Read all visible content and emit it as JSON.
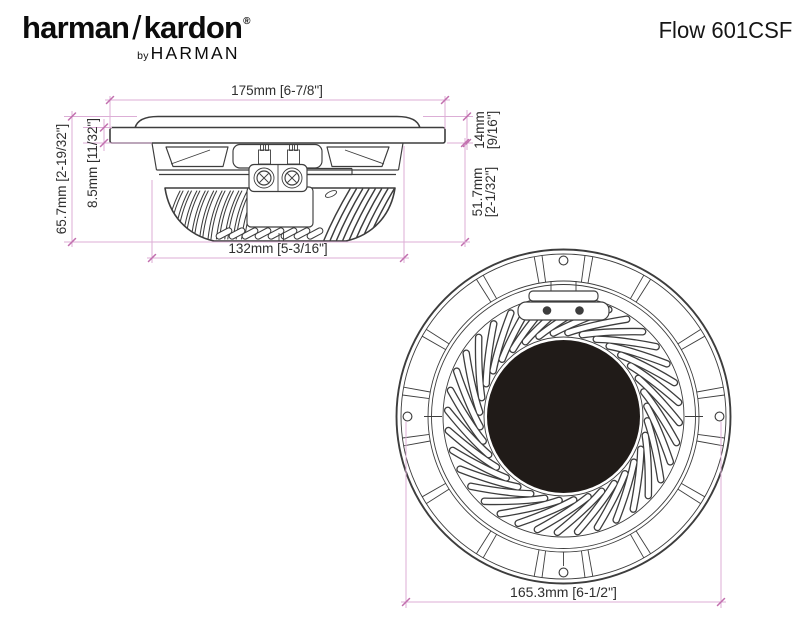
{
  "header": {
    "logo": {
      "part1": "harman",
      "slash": "/",
      "part2": "kardon",
      "reg": "®",
      "by": "by",
      "brand": "HARMAN"
    },
    "model": "Flow 601CSF"
  },
  "colors": {
    "line": "#3d3d3d",
    "dim": "#dcaed6",
    "tick": "#c26fae",
    "text": "#2e2e2e",
    "magnet": "#201b18",
    "bg": "#ffffff"
  },
  "side_view": {
    "dims": {
      "width_top": "175mm [6-7/8\"]",
      "flange_height_l1": "14mm",
      "flange_height_l2": "[9/16\"]",
      "depth_below_l1": "51.7mm",
      "depth_below_l2": "[2-1/32\"]",
      "total_height": "65.7mm [2-19/32\"]",
      "flange_thickness": "8.5mm [11/32\"]",
      "width_bottom": "132mm [5-3/16\"]"
    }
  },
  "front_view": {
    "dims": {
      "mounting_circle": "165.3mm [6-1/2\"]"
    }
  }
}
